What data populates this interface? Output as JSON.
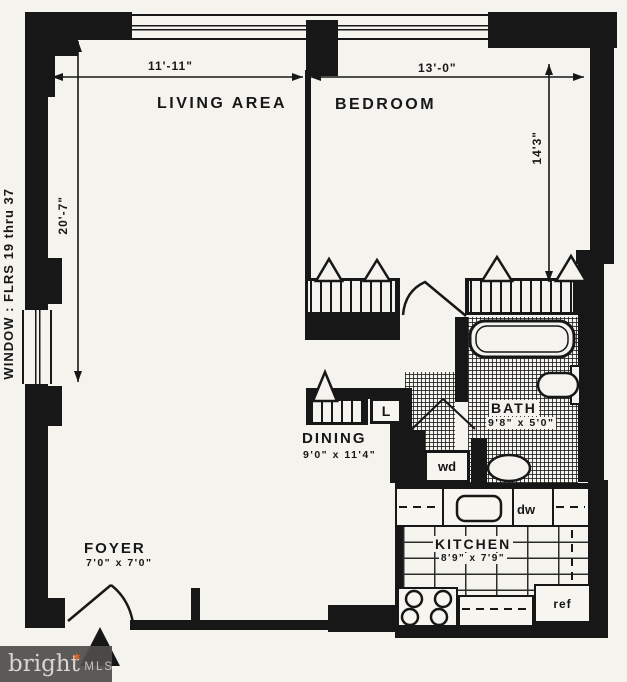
{
  "plan": {
    "window_note": "WINDOW : FLRS 19 thru 37",
    "dimensions": {
      "living_width": "11'-11\"",
      "bedroom_width": "13'-0\"",
      "living_depth": "20'-7\"",
      "bedroom_depth": "14'3\""
    },
    "rooms": {
      "living": {
        "label": "LIVING AREA"
      },
      "bedroom": {
        "label": "BEDROOM"
      },
      "dining": {
        "label": "DINING",
        "size": "9'0\" x 11'4\""
      },
      "bath": {
        "label": "BATH",
        "size": "9'8\" x 5'0\""
      },
      "kitchen": {
        "label": "KITCHEN",
        "size": "8'9\" x 7'9\""
      },
      "foyer": {
        "label": "FOYER",
        "size": "7'0\" x 7'0\""
      }
    },
    "fixtures": {
      "washer_dryer": "wd",
      "dishwasher": "dw",
      "refrigerator": "ref",
      "linen_closet": "L"
    }
  },
  "watermark": {
    "brand": "bright",
    "mls": "MLS",
    "star_glyph": "✱"
  },
  "colors": {
    "ink": "#171717",
    "paper": "#f5f3ee",
    "watermark_bg": "#504e4c",
    "star": "#e0662a"
  }
}
